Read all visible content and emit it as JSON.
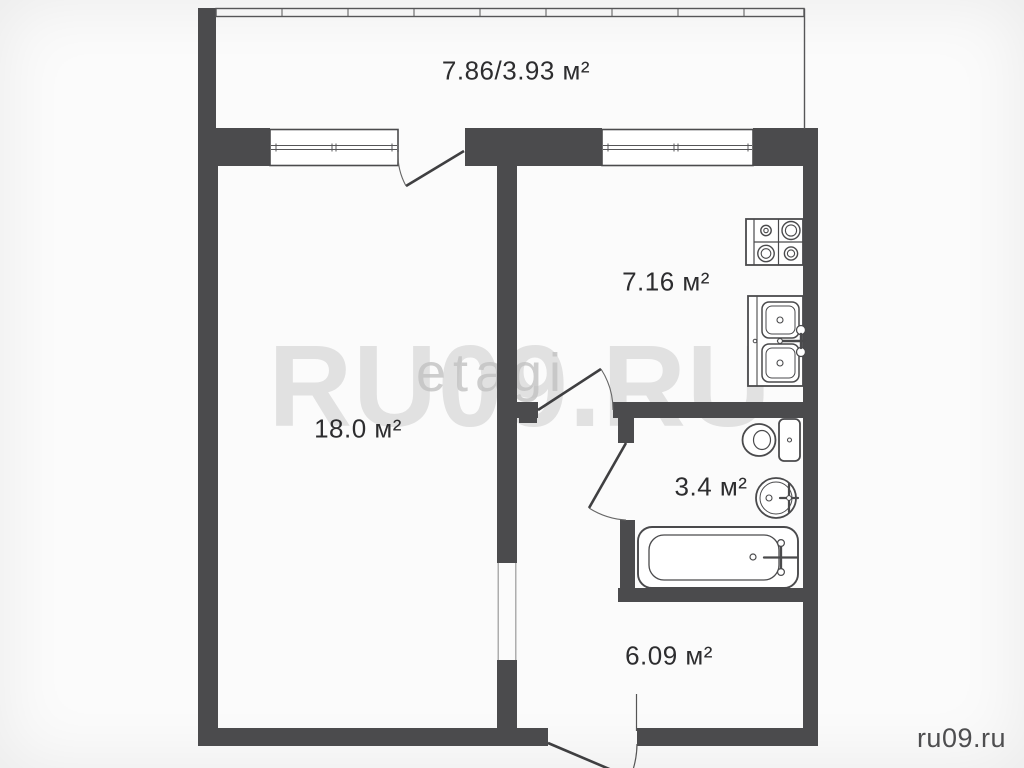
{
  "canvas": {
    "background": "#fbfbfb"
  },
  "colors": {
    "wall": "#4b4b4d",
    "fixture_stroke": "#4a4a4c",
    "thin_line": "#565658",
    "label_text": "#2d2d2f",
    "watermark": "#d2d2d2",
    "footer_text": "#4e4e50"
  },
  "plan": {
    "rooms": [
      {
        "name": "balcony",
        "label": "7.86/3.93 м²"
      },
      {
        "name": "living-room",
        "label": "18.0 м²"
      },
      {
        "name": "kitchen",
        "label": "7.16 м²"
      },
      {
        "name": "bathroom",
        "label": "3.4 м²"
      },
      {
        "name": "hallway",
        "label": "6.09 м²"
      }
    ],
    "fixtures": [
      "stove",
      "kitchen-sink",
      "toilet",
      "washbasin",
      "bathtub"
    ]
  },
  "watermark": {
    "primary": "RU09.RU",
    "secondary": "etagi"
  },
  "footer": {
    "site_label": "ru09.ru"
  }
}
